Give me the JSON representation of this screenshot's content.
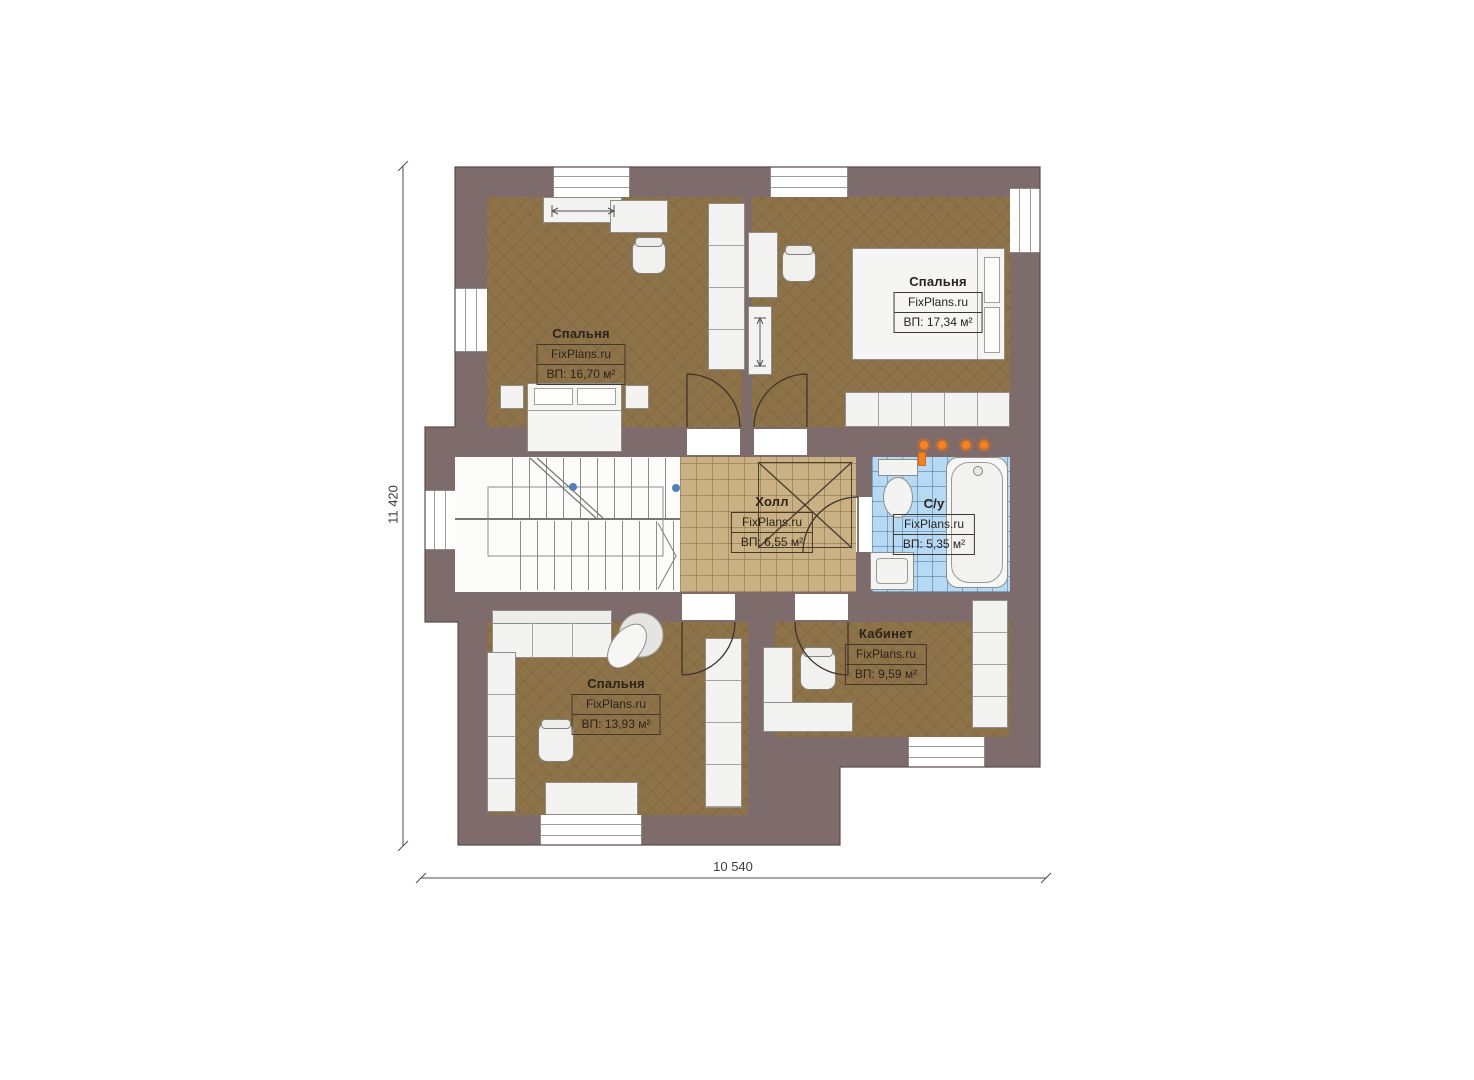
{
  "plan": {
    "source_brand": "FixPlans.ru",
    "floor_type": "second-floor-plan"
  },
  "colors": {
    "wall": "#7e6b6b",
    "bedroom_floor": "#8e7349",
    "hall_floor": "#c9b183",
    "bathroom_floor": "#b7daf4",
    "furniture": "#f3f3f1",
    "heating_dot": "#f5821f",
    "stair_marker_blue": "#4f7fbe",
    "label_text": "#2b231c"
  },
  "dimensions": {
    "height": "11 420",
    "width": "10 540"
  },
  "rooms": [
    {
      "name": "bedroom-top-left",
      "title": "Спальня",
      "brand": "FixPlans.ru",
      "area": "ВП: 16,70 м²"
    },
    {
      "name": "bedroom-top-right",
      "title": "Спальня",
      "brand": "FixPlans.ru",
      "area": "ВП: 17,34 м²"
    },
    {
      "name": "hall",
      "title": "Холл",
      "brand": "FixPlans.ru",
      "area": "ВП: 6,55 м²"
    },
    {
      "name": "bathroom",
      "title": "С/у",
      "brand": "FixPlans.ru",
      "area": "ВП: 5,35 м²"
    },
    {
      "name": "bedroom-bottom-left",
      "title": "Спальня",
      "brand": "FixPlans.ru",
      "area": "ВП: 13,93 м²"
    },
    {
      "name": "office",
      "title": "Кабинет",
      "brand": "FixPlans.ru",
      "area": "ВП: 9,59 м²"
    }
  ]
}
